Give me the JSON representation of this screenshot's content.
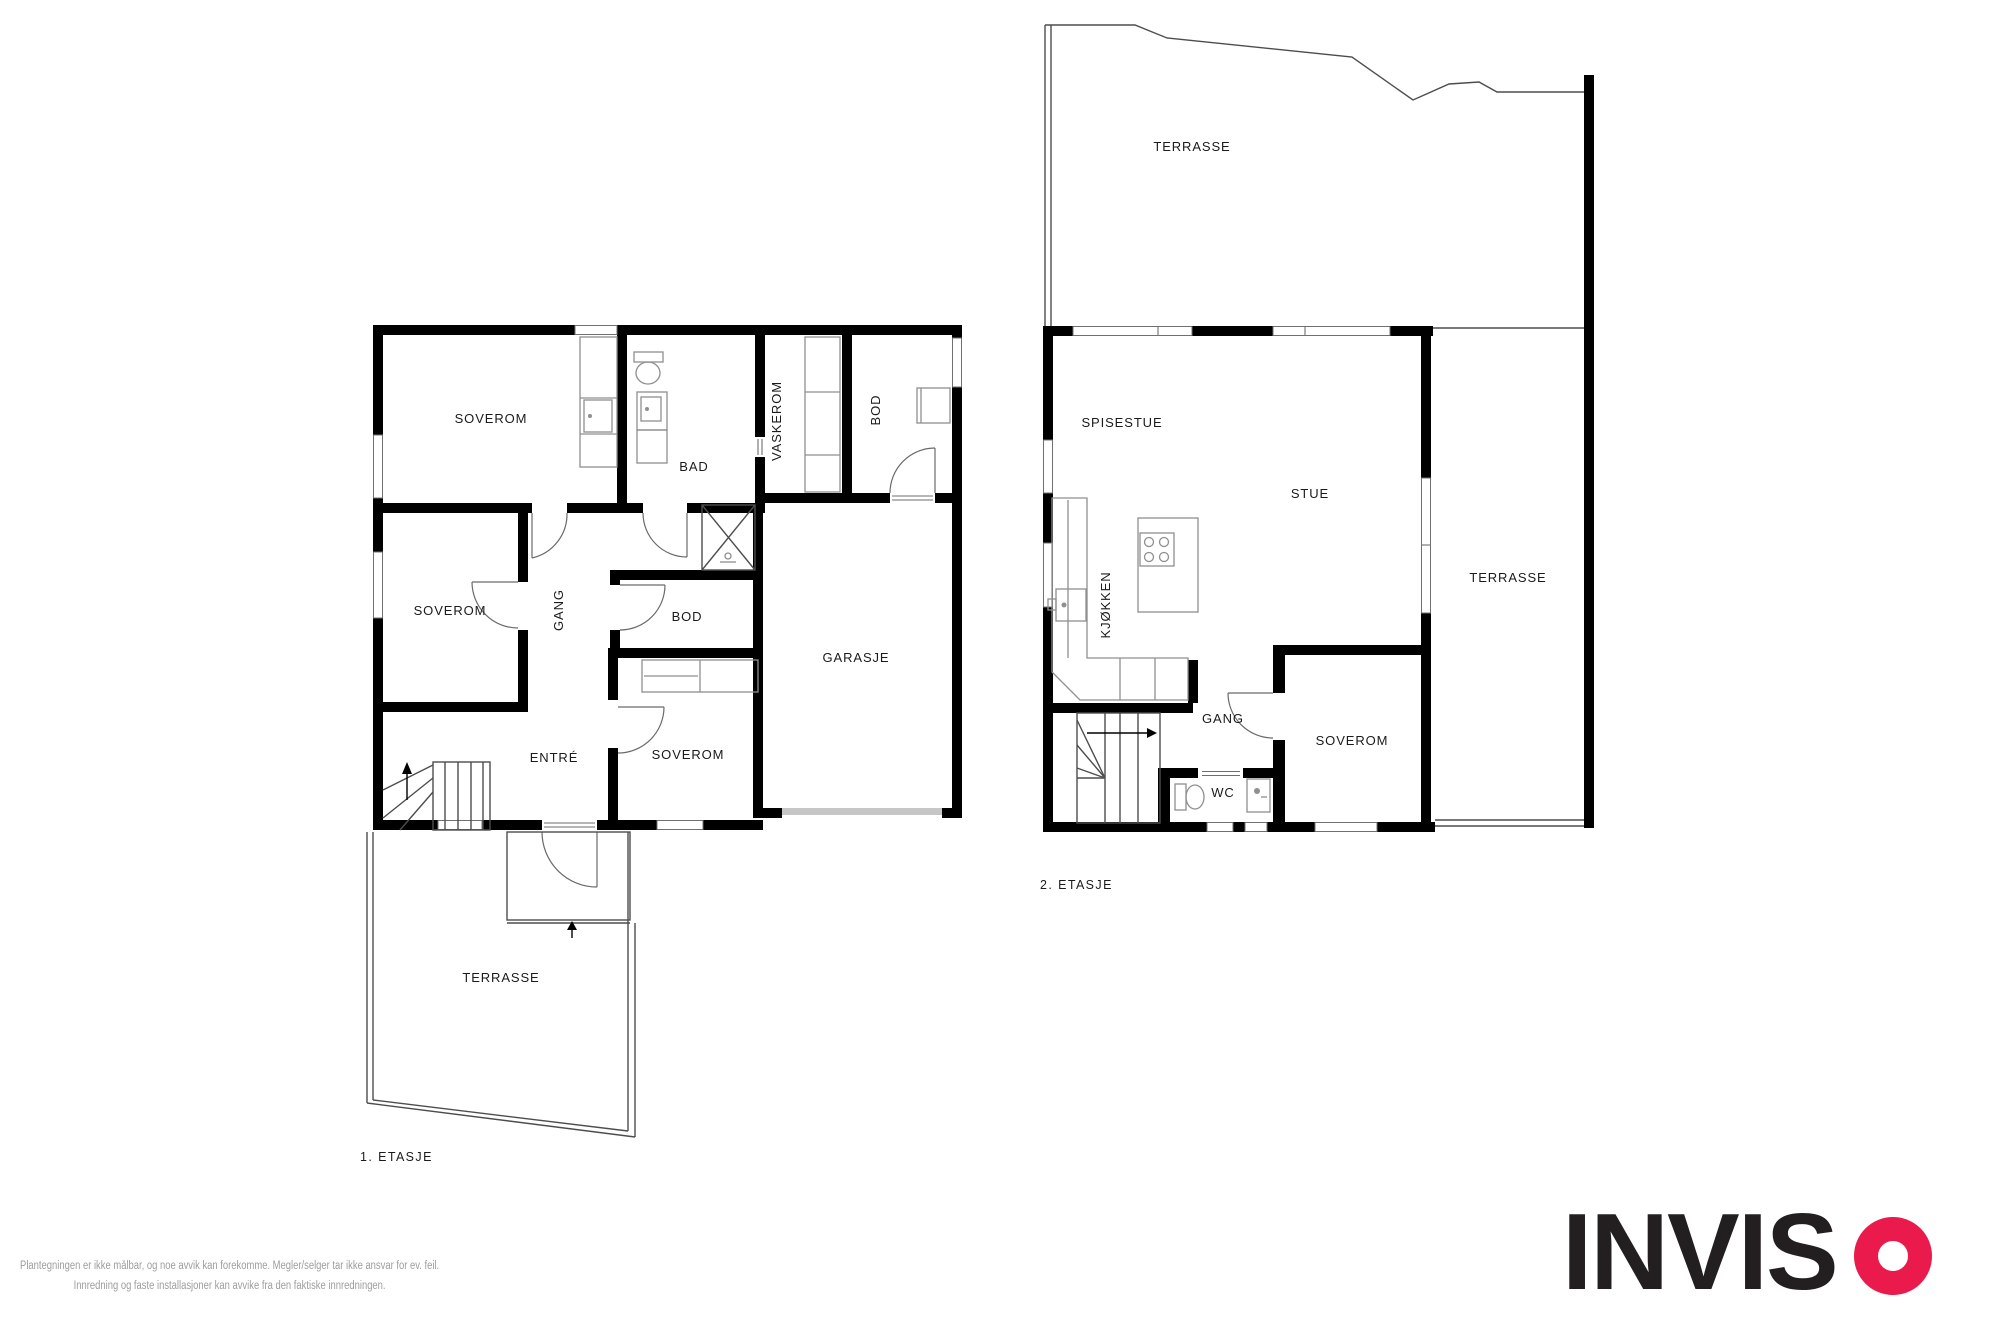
{
  "floor1": {
    "title": "1. ETASJE",
    "rooms": {
      "soverom1": "SOVEROM",
      "bad": "BAD",
      "vaskerom": "VASKEROM",
      "bod_top": "BOD",
      "soverom2": "SOVEROM",
      "gang": "GANG",
      "bod_mid": "BOD",
      "garasje": "GARASJE",
      "entre": "ENTRÉ",
      "soverom3": "SOVEROM",
      "terrasse": "TERRASSE"
    }
  },
  "floor2": {
    "title": "2. ETASJE",
    "rooms": {
      "terrasse_top": "TERRASSE",
      "spisestue": "SPISESTUE",
      "stue": "STUE",
      "kjokken": "KJØKKEN",
      "gang": "GANG",
      "soverom": "SOVEROM",
      "wc": "WC",
      "terrasse_right": "TERRASSE"
    }
  },
  "disclaimer": {
    "line1": "Plantegningen er ikke målbar, og noe avvik kan forekomme. Megler/selger tar ikke ansvar for ev. feil.",
    "line2": "Innredning og faste installasjoner kan avvike fra den faktiske innredningen."
  },
  "logo": {
    "letters": "INVIS",
    "o": "O"
  },
  "colors": {
    "wall": "#000000",
    "thin_line": "#4d4d4d",
    "furniture": "#8f8f8f",
    "label": "#1b1b1b",
    "disclaimer_text": "#9d9d9d",
    "logo_black": "#231f20",
    "logo_red": "#ea1a4d",
    "garage_door": "#c6c6c6"
  }
}
